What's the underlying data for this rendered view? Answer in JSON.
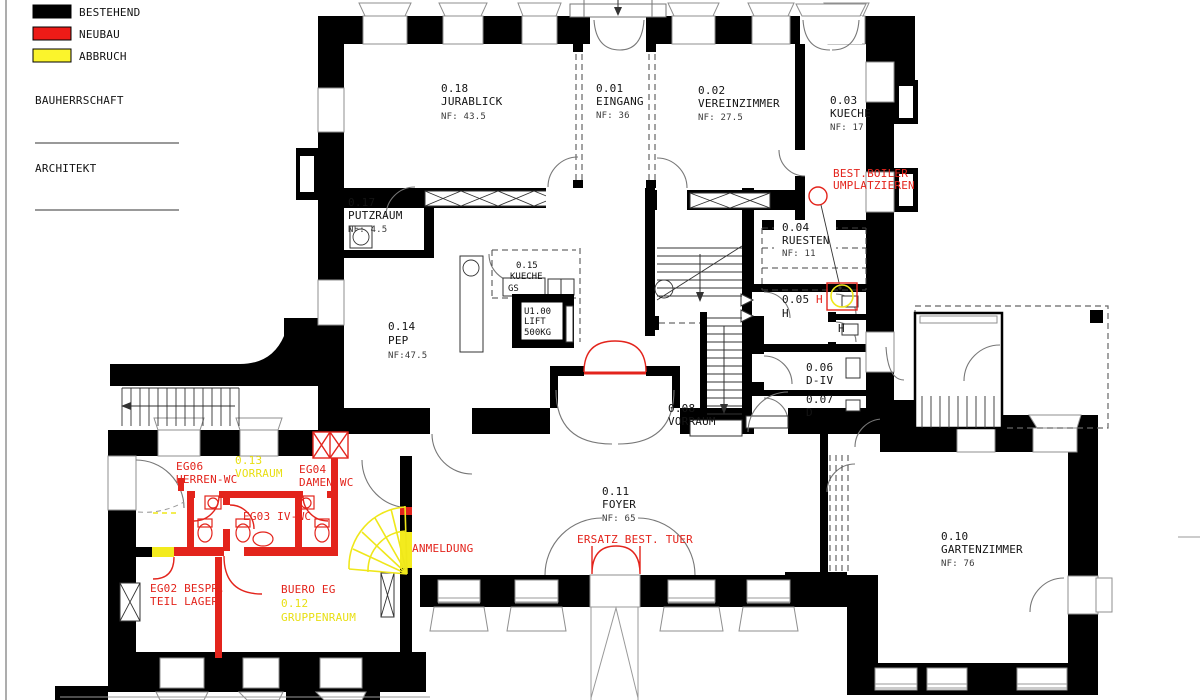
{
  "legend": {
    "items": [
      {
        "label": "BESTEHEND",
        "color": "#000000"
      },
      {
        "label": "NEUBAU",
        "color": "#ed1b17"
      },
      {
        "label": "ABBRUCH",
        "color": "#fbf42c"
      }
    ],
    "bauherrschaft": "BAUHERRSCHAFT",
    "architekt": "ARCHITEKT"
  },
  "rooms": {
    "jurablick": {
      "num": "0.18",
      "name": "JURABLICK",
      "area": "NF: 43.5"
    },
    "eingang": {
      "num": "0.01",
      "name": "EINGANG",
      "area": "NF: 36"
    },
    "vereinzimmer": {
      "num": "0.02",
      "name": "VEREINZIMMER",
      "area": "NF: 27.5"
    },
    "kueche03": {
      "num": "0.03",
      "name": "KUECHE",
      "area": "NF: 17"
    },
    "putzraum": {
      "num": "0.17",
      "name": "PUTZRAUM",
      "area": "NF: 4.5"
    },
    "ruesten": {
      "num": "0.04",
      "name": "RUESTEN",
      "area": "NF: 11"
    },
    "kueche15": {
      "num": "0.15",
      "name": "KUECHE"
    },
    "pep": {
      "num": "0.14",
      "name": "PEP",
      "area": "NF:47.5"
    },
    "lift": {
      "num": "U1.00",
      "name": "LIFT",
      "cap": "500KG"
    },
    "r05": {
      "num": "0.05",
      "name": "H"
    },
    "r06": {
      "num": "0.06",
      "name": "D-IV"
    },
    "r07": {
      "num": "0.07",
      "name": "D"
    },
    "vorraum08": {
      "num": "0.08",
      "name": "VORRAUM"
    },
    "foyer": {
      "num": "0.11",
      "name": "FOYER",
      "area": "NF: 65"
    },
    "gartenzimmer": {
      "num": "0.10",
      "name": "GARTENZIMMER",
      "area": "NF: 76"
    },
    "vorraum13": {
      "num": "0.13",
      "name": "VORRAUM"
    },
    "gruppenraum": {
      "num": "0.12",
      "name": "GRUPPENRAUM"
    }
  },
  "annotations": {
    "gs": "GS",
    "h_red": "H",
    "h_black": "H",
    "boiler_line1": "BEST.BOILER",
    "boiler_line2": "UMPLATZIEREN",
    "ersatz_tuer": "ERSATZ BEST. TUER",
    "anmeldung": "ANMELDUNG",
    "eg06_line1": "EG06",
    "eg06_line2": "HERREN-WC",
    "eg04_line1": "EG04",
    "eg04_line2": "DAMEN-WC",
    "eg03": "EG03 IV-WC",
    "eg02_line1": "EG02 BESPR.",
    "eg02_line2": "TEIL LAGER",
    "buero": "BUERO EG"
  },
  "colors": {
    "bestehend": "#000000",
    "neubau": "#e3241c",
    "abbruch": "#f3eb1e"
  }
}
